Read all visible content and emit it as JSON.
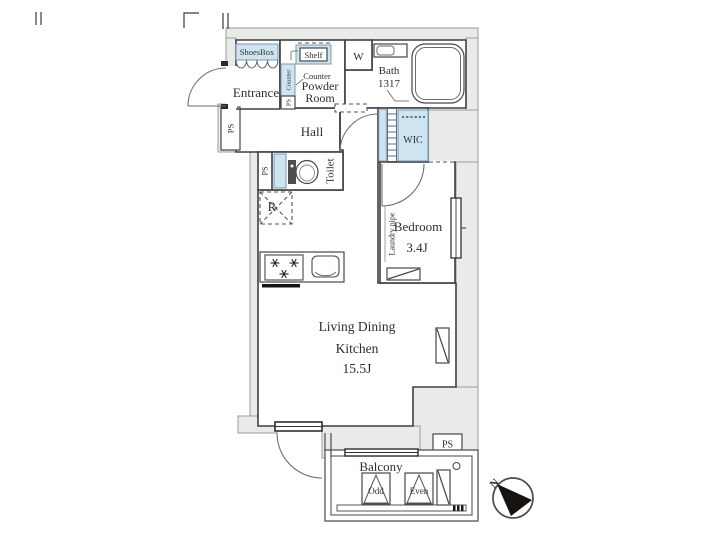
{
  "colors": {
    "fixture_blue": "#cfe4f1",
    "wall_gray": "#e9ebe8",
    "line": "#3f3f3f"
  },
  "rooms": {
    "entrance": "Entrance",
    "powder_line1": "Powder",
    "powder_line2": "Room",
    "hall": "Hall",
    "toilet": "Toilet",
    "bath": "Bath",
    "bath_size": "1317",
    "wic": "WIC",
    "bedroom": "Bedroom",
    "bedroom_size": "3.4J",
    "ldk_line1": "Living Dining",
    "ldk_line2": "Kitchen",
    "ldk_size": "15.5J",
    "balcony": "Balcony"
  },
  "fixtures": {
    "shoes_box": "ShoesBox",
    "shelf": "Shelf",
    "counter": "Counter",
    "counter_strip": "Counter",
    "washer": "W",
    "refrigerator": "R",
    "laundry_pipe": "Laundry pipe",
    "odd_panel": "Odd",
    "even_panel": "Even"
  },
  "shafts": {
    "ps_entrance": "PS",
    "ps_powder": "PS",
    "ps_toilet": "PS",
    "ps_balcony": "PS"
  },
  "compass": {
    "north": "N"
  }
}
